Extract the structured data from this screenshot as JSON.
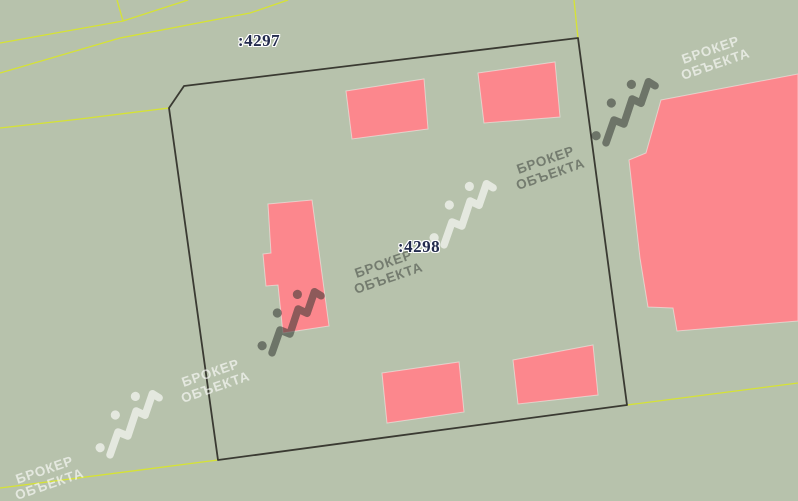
{
  "map": {
    "background_color": "#b7c2ac",
    "parcel_line_color": "#3a3a32",
    "road_line_color": "#d6e334",
    "building_fill_color": "#fc878d",
    "label_color": "#232b4d",
    "labels": [
      {
        "text": ":4297",
        "x": 259,
        "y": 41
      },
      {
        "text": ":4298",
        "x": 419,
        "y": 247
      }
    ],
    "parcel_boundary": [
      [
        169,
        108
      ],
      [
        184,
        86
      ],
      [
        578,
        38
      ],
      [
        627,
        405
      ],
      [
        218,
        460
      ]
    ],
    "road_lines": [
      [
        [
          0,
          43
        ],
        [
          123,
          21
        ],
        [
          188,
          0
        ]
      ],
      [
        [
          117,
          0
        ],
        [
          123,
          21
        ]
      ],
      [
        [
          0,
          73
        ],
        [
          120,
          38
        ],
        [
          250,
          13
        ],
        [
          288,
          0
        ]
      ],
      [
        [
          0,
          128
        ],
        [
          80,
          119
        ],
        [
          169,
          108
        ]
      ],
      [
        [
          0,
          488
        ],
        [
          218,
          460
        ]
      ],
      [
        [
          627,
          405
        ],
        [
          798,
          383
        ]
      ],
      [
        [
          574,
          0
        ],
        [
          578,
          38
        ]
      ]
    ],
    "buildings": [
      [
        [
          346,
          91
        ],
        [
          424,
          79
        ],
        [
          428,
          129
        ],
        [
          352,
          139
        ]
      ],
      [
        [
          478,
          73
        ],
        [
          555,
          62
        ],
        [
          560,
          117
        ],
        [
          484,
          123
        ]
      ],
      [
        [
          268,
          204
        ],
        [
          312,
          200
        ],
        [
          329,
          326
        ],
        [
          283,
          333
        ],
        [
          278,
          285
        ],
        [
          266,
          286
        ],
        [
          263,
          254
        ],
        [
          271,
          253
        ]
      ],
      [
        [
          382,
          373
        ],
        [
          459,
          362
        ],
        [
          464,
          412
        ],
        [
          387,
          423
        ]
      ],
      [
        [
          513,
          360
        ],
        [
          593,
          345
        ],
        [
          598,
          395
        ],
        [
          518,
          404
        ]
      ],
      [
        [
          661,
          100
        ],
        [
          798,
          74
        ],
        [
          798,
          321
        ],
        [
          677,
          331
        ],
        [
          673,
          308
        ],
        [
          648,
          307
        ],
        [
          640,
          258
        ],
        [
          629,
          160
        ],
        [
          646,
          153
        ]
      ]
    ]
  },
  "watermark": {
    "line1": "БРОКЕР",
    "line2": "ОБЪЕКТА",
    "dark_color": "rgba(50,53,49,0.5)",
    "light_color": "rgba(255,255,255,0.62)",
    "instances": [
      {
        "type": "text",
        "x": 713,
        "y": 57,
        "tone": "light"
      },
      {
        "type": "logo",
        "x": 625,
        "y": 112,
        "tone": "dark"
      },
      {
        "type": "text",
        "x": 548,
        "y": 167,
        "tone": "dark"
      },
      {
        "type": "logo",
        "x": 463,
        "y": 214,
        "tone": "light"
      },
      {
        "type": "text",
        "x": 386,
        "y": 271,
        "tone": "dark"
      },
      {
        "type": "logo",
        "x": 291,
        "y": 322,
        "tone": "dark"
      },
      {
        "type": "text",
        "x": 213,
        "y": 380,
        "tone": "light"
      },
      {
        "type": "logo",
        "x": 129,
        "y": 424,
        "tone": "light"
      },
      {
        "type": "text",
        "x": 47,
        "y": 477,
        "tone": "light"
      }
    ]
  }
}
